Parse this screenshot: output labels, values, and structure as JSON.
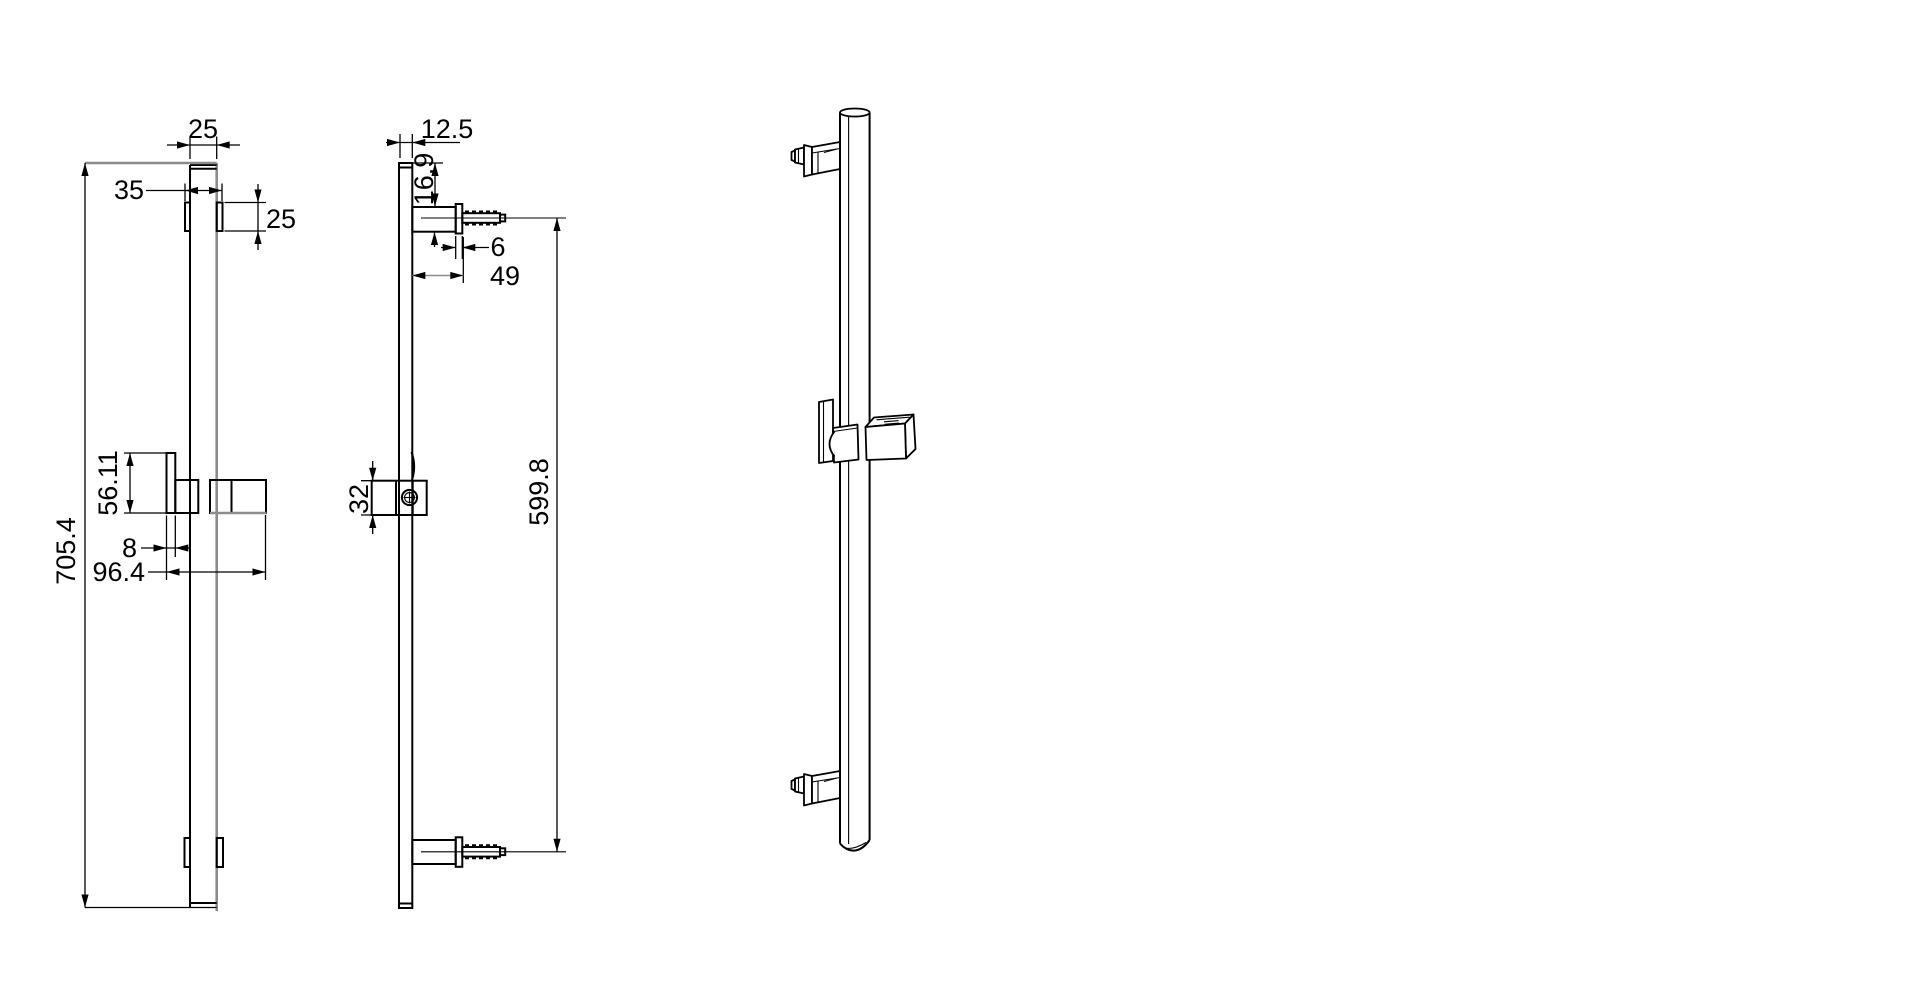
{
  "palette": {
    "line": "#000000",
    "gray_line": "#8c8c8c",
    "background": "#ffffff"
  },
  "dimensions": {
    "front": {
      "bar_width": "25",
      "bracket_width": "35",
      "bracket_height": "25",
      "slider_height": "56.11",
      "plate_thickness": "8",
      "holder_reach": "96.4",
      "overall_length": "705.4"
    },
    "side": {
      "bar_depth": "12.5",
      "top_offset": "16.9",
      "flange_thickness": "6",
      "arm_reach": "49",
      "slider_body_height": "32",
      "mount_centers": "599.8"
    }
  }
}
